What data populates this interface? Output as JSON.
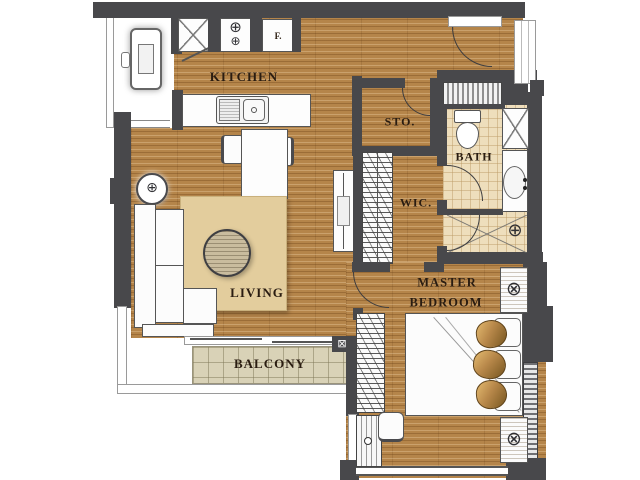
{
  "plan_title": "apartment-floor-plan",
  "rooms": {
    "kitchen": {
      "label": "KITCHEN"
    },
    "living": {
      "label": "LIVING"
    },
    "balcony": {
      "label": "BALCONY"
    },
    "storage": {
      "label": "STO."
    },
    "walk_in_closet": {
      "label": "WIC."
    },
    "bath": {
      "label": "BATH"
    },
    "master_bedroom": {
      "label_line1": "MASTER",
      "label_line2": "BEDROOM"
    }
  },
  "appliances": {
    "fridge_label": "F."
  },
  "icons": {
    "burner_icon": "⊕",
    "lamp_icon": "⊗",
    "shower_icon": "⊕",
    "ac_unit_icon": "⊠",
    "table_lamp_icon": "⊕"
  },
  "colors": {
    "wall": "#48484b",
    "wood_floor": "#b5854a",
    "bath_tile": "#eedebc",
    "balcony_tile": "#d9d2b7",
    "rug": "#e3cd9d",
    "pillow_gold": "#c49551",
    "label_text": "#2a1c10"
  }
}
